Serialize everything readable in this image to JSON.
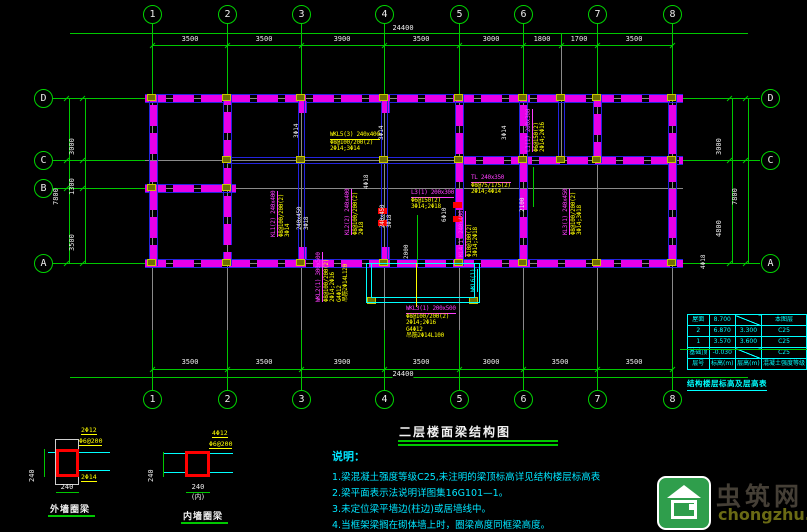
{
  "drawing_title": "二层楼面梁结构图",
  "axes": {
    "top_numbers": [
      "1",
      "2",
      "3",
      "4",
      "5",
      "6",
      "7",
      "8"
    ],
    "bottom_numbers": [
      "1",
      "2",
      "3",
      "4",
      "5",
      "6",
      "7",
      "8"
    ],
    "left_letters": [
      "D",
      "C",
      "B",
      "A"
    ],
    "right_letters": [
      "D",
      "C",
      "A"
    ],
    "top_dims": [
      "3500",
      "3500",
      "3900",
      "3500",
      "3000",
      "1800",
      "1700",
      "3500"
    ],
    "top_total": "24400",
    "bottom_dims": [
      "3500",
      "3500",
      "3900",
      "3500",
      "3000",
      "3500",
      "3500"
    ],
    "bottom_total": "24400",
    "left_dims": [
      "3000",
      "1300",
      "3500"
    ],
    "left_total": "7800",
    "right_dims": [
      "3000",
      "4800"
    ],
    "right_total": "7800"
  },
  "beam_labels": [
    {
      "id": "wkl5",
      "dir": "h",
      "x": 330,
      "y": 132,
      "lines": [
        {
          "t": "WKL5(3) 240x400",
          "c": "y",
          "u": true
        },
        {
          "t": "Φ8@100/200(2)",
          "c": "y"
        },
        {
          "t": "2Φ14;3Φ14",
          "c": "y"
        }
      ]
    },
    {
      "id": "l3",
      "dir": "h",
      "x": 411,
      "y": 190,
      "lines": [
        {
          "t": "L3(1) 200x300",
          "c": "m",
          "u": true
        },
        {
          "t": "Φ6@150(2)",
          "c": "y"
        },
        {
          "t": "3Φ14;2Φ18",
          "c": "y"
        }
      ]
    },
    {
      "id": "tl",
      "dir": "h",
      "x": 471,
      "y": 175,
      "lines": [
        {
          "t": "TL 240x350",
          "c": "m",
          "u": true
        },
        {
          "t": "Φ8@75/175(2)",
          "c": "y"
        },
        {
          "t": "2Φ14;4Φ14",
          "c": "y"
        }
      ]
    },
    {
      "id": "wkl3",
      "dir": "h",
      "x": 406,
      "y": 306,
      "lines": [
        {
          "t": "WKL3(1) 200x500",
          "c": "m",
          "u": true
        },
        {
          "t": "Φ8@100/200(2)",
          "c": "y"
        },
        {
          "t": "2Φ14;2Φ16",
          "c": "y"
        },
        {
          "t": "G4Φ12",
          "c": "y"
        },
        {
          "t": "吊筋2Φ14L100",
          "c": "y"
        }
      ]
    },
    {
      "id": "kl1",
      "dir": "v",
      "x": 278,
      "y": 237,
      "lines": [
        {
          "t": "KL1(2) 240x400",
          "c": "m",
          "u": true
        },
        {
          "t": "Φ8@100/200(2)",
          "c": "y"
        },
        {
          "t": "3Φ14",
          "c": "y"
        }
      ]
    },
    {
      "id": "sec1",
      "dir": "v",
      "x": 303,
      "y": 230,
      "lines": [
        {
          "t": "240x450",
          "c": "w"
        },
        {
          "t": "3Φ18",
          "c": "w"
        }
      ]
    },
    {
      "id": "kl2",
      "dir": "v",
      "x": 352,
      "y": 235,
      "lines": [
        {
          "t": "KL2(2) 240x400",
          "c": "m",
          "u": true
        },
        {
          "t": "Φ8@100/200(2)",
          "c": "y"
        },
        {
          "t": "2Φ18",
          "c": "y"
        }
      ]
    },
    {
      "id": "sec2",
      "dir": "v",
      "x": 386,
      "y": 228,
      "lines": [
        {
          "t": "240x450",
          "c": "w"
        },
        {
          "t": "3Φ18",
          "c": "w"
        }
      ]
    },
    {
      "id": "kl4",
      "dir": "v",
      "x": 466,
      "y": 257,
      "lines": [
        {
          "t": "KL4(1) 240x400",
          "c": "m",
          "u": true
        },
        {
          "t": "Φ10@100(2)",
          "c": "y"
        },
        {
          "t": "3Φ14;2Φ18",
          "c": "y"
        }
      ]
    },
    {
      "id": "l1",
      "dir": "v",
      "x": 533,
      "y": 152,
      "lines": [
        {
          "t": "L1(1) 200x300",
          "c": "m",
          "u": true
        },
        {
          "t": "Φ6@150(2)",
          "c": "y"
        },
        {
          "t": "2Φ14;2Φ16",
          "c": "y"
        }
      ]
    },
    {
      "id": "kl3",
      "dir": "v",
      "x": 570,
      "y": 235,
      "lines": [
        {
          "t": "KL3(1) 240x450",
          "c": "m",
          "u": true
        },
        {
          "t": "Φ8@100/200(2)",
          "c": "y"
        },
        {
          "t": "3Φ14;3Φ18",
          "c": "y"
        }
      ]
    },
    {
      "id": "wkl2",
      "dir": "v",
      "x": 323,
      "y": 302,
      "lines": [
        {
          "t": "WKL2(1) 300x500",
          "c": "m",
          "u": true
        },
        {
          "t": "Φ8@100/200(2)",
          "c": "y"
        },
        {
          "t": "2Φ14;2Φ16",
          "c": "y"
        },
        {
          "t": "G4Φ12",
          "c": "y"
        },
        {
          "t": "吊筋2Φ14L120",
          "c": "y"
        }
      ]
    },
    {
      "id": "wkl6",
      "dir": "v",
      "x": 478,
      "y": 292,
      "lines": [
        {
          "t": "WKL6(1)",
          "c": "c",
          "u": true
        }
      ]
    }
  ],
  "small_marks": [
    {
      "t": "3Φ14",
      "x": 300,
      "y": 131
    },
    {
      "t": "3Φ14",
      "x": 385,
      "y": 133
    },
    {
      "t": "3Φ14",
      "x": 508,
      "y": 133
    },
    {
      "t": "4Φ18",
      "x": 370,
      "y": 182
    },
    {
      "t": "4Φ18",
      "x": 707,
      "y": 262
    },
    {
      "t": "6Φ10",
      "x": 448,
      "y": 215
    },
    {
      "t": "2000",
      "x": 410,
      "y": 252
    },
    {
      "t": "2100",
      "x": 526,
      "y": 205
    }
  ],
  "notes": {
    "heading": "说明：",
    "items": [
      "1.梁混凝土强度等级C25,未注明的梁顶标高详见结构楼层标高表",
      "2.梁平面表示法说明详图集16G101—1。",
      "3.未定位梁平墙边(柱边)或居墙线中。",
      "4.当框架梁搁在砌体墙上时，圈梁高度同框梁高度。"
    ]
  },
  "floor_table": {
    "rows": [
      [
        "屋面",
        "8.700",
        "DIAG",
        "本图层"
      ],
      [
        "2",
        "6.870",
        "3.300",
        "C25"
      ],
      [
        "1",
        "3.570",
        "3.600",
        "C25"
      ],
      [
        "基础顶",
        "-0.030",
        "DIAG",
        "C25"
      ],
      [
        "层号",
        "标高(m)",
        "层高(m)",
        "混凝土强度等级"
      ]
    ],
    "caption": "结构楼层标高及层高表"
  },
  "details": [
    {
      "caption": "外墙圈梁",
      "top_bar": "2Φ12",
      "stirrup": "Φ6@200",
      "bottom_bar": "2Φ14",
      "dim_w": "240",
      "dim_h": "240",
      "suffix": ""
    },
    {
      "caption": "内墙圈梁",
      "top_bar": "4Φ12",
      "stirrup": "Φ6@200",
      "bottom_bar": "",
      "dim_w": "240",
      "dim_h": "240",
      "suffix": "(内)"
    }
  ],
  "watermark": {
    "name": "虫筑网",
    "url": "chongzhu.cn"
  }
}
